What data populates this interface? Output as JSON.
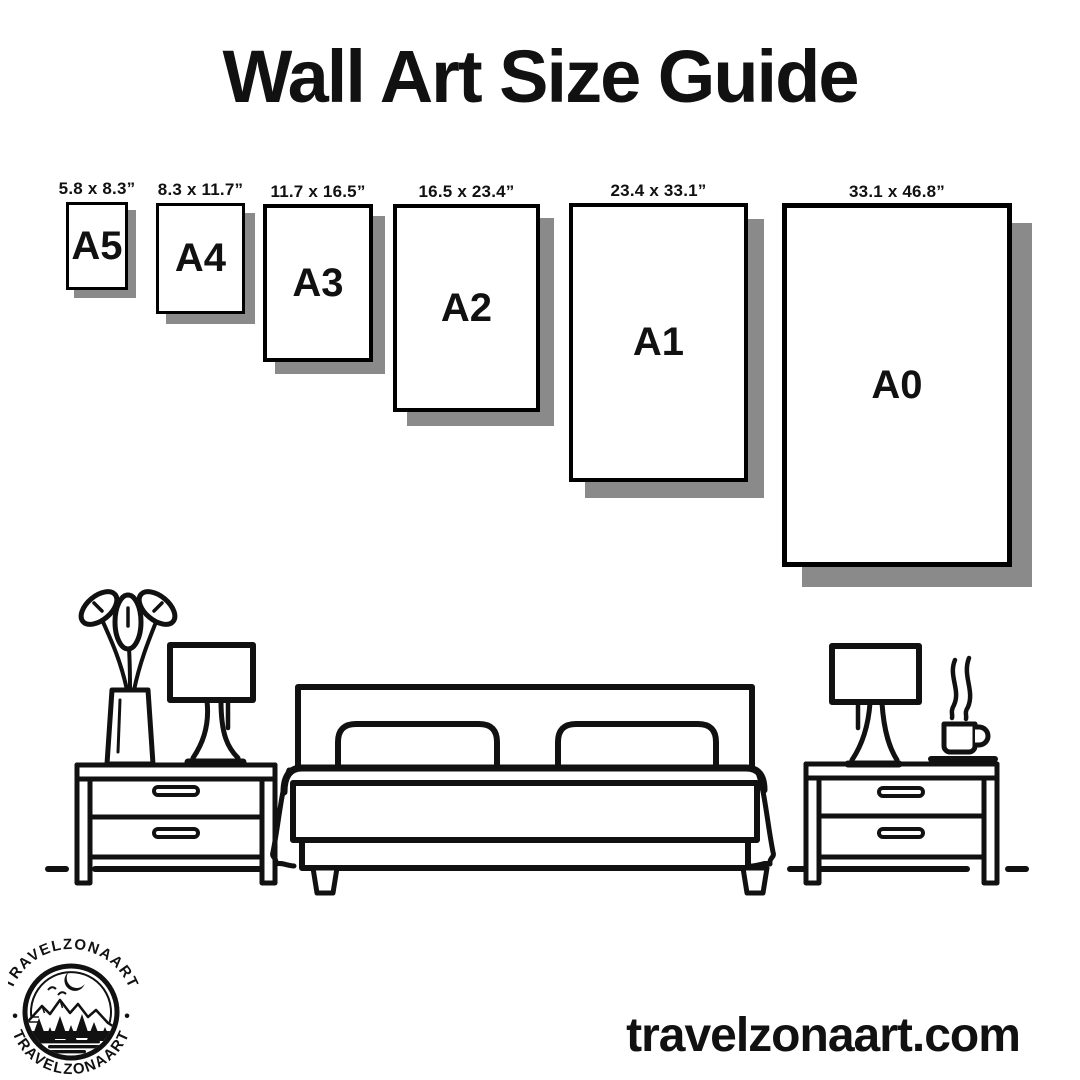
{
  "title": "Wall Art Size Guide",
  "papers": [
    {
      "name": "A5",
      "dimensions": "5.8 x 8.3”"
    },
    {
      "name": "A4",
      "dimensions": "8.3 x 11.7”"
    },
    {
      "name": "A3",
      "dimensions": "11.7 x 16.5”"
    },
    {
      "name": "A2",
      "dimensions": "16.5 x 23.4”"
    },
    {
      "name": "A1",
      "dimensions": "23.4 x 33.1”"
    },
    {
      "name": "A0",
      "dimensions": "33.1 x 46.8”"
    }
  ],
  "logo": {
    "text_top": "TRAVELZONAART",
    "text_bottom": "TRAVELZONAART",
    "separator": "•"
  },
  "website": "travelzonaart.com",
  "colors": {
    "ink": "#111111",
    "paper_shadow": "#8a8a8a",
    "background": "#ffffff"
  }
}
